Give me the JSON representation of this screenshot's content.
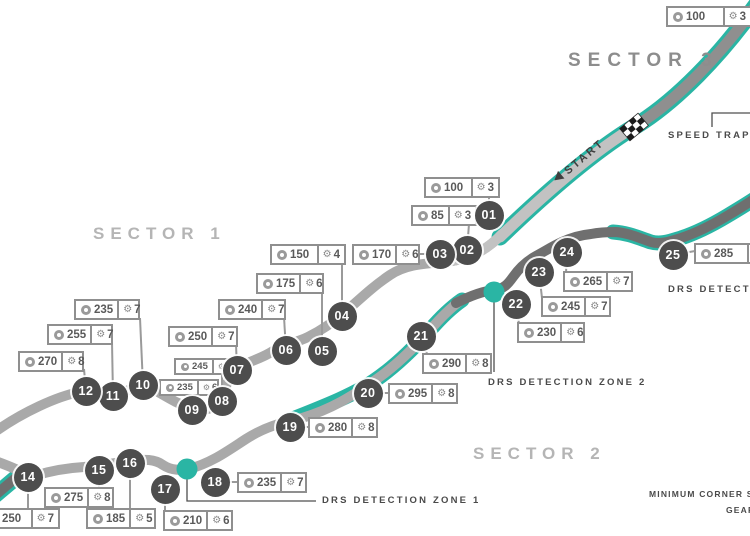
{
  "colors": {
    "teal": "#2ab5a4",
    "track_gray": "#a9a9a9",
    "track_light": "#c2c2c2",
    "track_dark": "#6f6f6f",
    "marker": "#4d4d4d"
  },
  "sector_labels": [
    "SECTOR 1",
    "SECTOR 2",
    "SECTOR 3"
  ],
  "start_label": "START",
  "speed_trap_label": "SPEED TRAP",
  "drs_labels": [
    "DRS DETECTION ZONE 1",
    "DRS DETECTION ZONE 2",
    "DRS DETECTION ZONE 3"
  ],
  "legend": {
    "speed_label": "MINIMUM CORNER SPEED",
    "gear_label": "GEAR"
  },
  "extra_label": {
    "speed": "100",
    "gear": "3",
    "bx": 666,
    "by": 6,
    "bw": 86
  },
  "corners": [
    {
      "num": "01",
      "speed": "100",
      "gear": "3",
      "cx": 489,
      "cy": 215,
      "bx": 424,
      "by": 177,
      "bw": 76,
      "small": false,
      "conn": [
        [
          489,
          215
        ],
        [
          489,
          198
        ]
      ]
    },
    {
      "num": "02",
      "speed": "85",
      "gear": "3",
      "cx": 467,
      "cy": 250,
      "bx": 411,
      "by": 205,
      "bw": 66,
      "small": false,
      "conn": [
        [
          467,
          250
        ],
        [
          469,
          224
        ]
      ]
    },
    {
      "num": "03",
      "speed": "170",
      "gear": "6",
      "cx": 440,
      "cy": 254,
      "bx": 352,
      "by": 244,
      "bw": 68,
      "small": false,
      "conn": [
        [
          440,
          254
        ],
        [
          418,
          254
        ]
      ]
    },
    {
      "num": "04",
      "speed": "150",
      "gear": "4",
      "cx": 342,
      "cy": 316,
      "bx": 270,
      "by": 244,
      "bw": 76,
      "small": false,
      "conn": [
        [
          342,
          316
        ],
        [
          342,
          262
        ]
      ]
    },
    {
      "num": "05",
      "speed": "175",
      "gear": "6",
      "cx": 322,
      "cy": 351,
      "bx": 256,
      "by": 273,
      "bw": 68,
      "small": false,
      "conn": [
        [
          322,
          351
        ],
        [
          322,
          291
        ]
      ]
    },
    {
      "num": "06",
      "speed": "240",
      "gear": "7",
      "cx": 286,
      "cy": 350,
      "bx": 218,
      "by": 299,
      "bw": 68,
      "small": false,
      "conn": [
        [
          286,
          350
        ],
        [
          284,
          317
        ]
      ]
    },
    {
      "num": "07",
      "speed": "250",
      "gear": "7",
      "cx": 237,
      "cy": 370,
      "bx": 168,
      "by": 326,
      "bw": 70,
      "small": false,
      "conn": [
        [
          237,
          370
        ],
        [
          236,
          344
        ]
      ]
    },
    {
      "num": "08",
      "speed": "245",
      "gear": "7",
      "cx": 222,
      "cy": 401,
      "bx": 174,
      "by": 358,
      "bw": 60,
      "small": true,
      "conn": [
        [
          222,
          401
        ],
        [
          222,
          374
        ]
      ]
    },
    {
      "num": "09",
      "speed": "235",
      "gear": "6",
      "cx": 192,
      "cy": 410,
      "bx": 159,
      "by": 379,
      "bw": 60,
      "small": true,
      "conn": [
        [
          192,
          410
        ],
        [
          192,
          395
        ]
      ]
    },
    {
      "num": "10",
      "speed": "235",
      "gear": "7",
      "cx": 143,
      "cy": 385,
      "bx": 74,
      "by": 299,
      "bw": 66,
      "small": false,
      "conn": [
        [
          143,
          385
        ],
        [
          140,
          318
        ]
      ]
    },
    {
      "num": "11",
      "speed": "255",
      "gear": "7",
      "cx": 113,
      "cy": 396,
      "bx": 47,
      "by": 324,
      "bw": 66,
      "small": false,
      "conn": [
        [
          113,
          396
        ],
        [
          112,
          342
        ]
      ]
    },
    {
      "num": "12",
      "speed": "270",
      "gear": "8",
      "cx": 86,
      "cy": 391,
      "bx": 18,
      "by": 351,
      "bw": 66,
      "small": false,
      "conn": [
        [
          86,
          391
        ],
        [
          84,
          369
        ]
      ]
    },
    {
      "num": "14",
      "speed": "250",
      "gear": "7",
      "cx": 28,
      "cy": 477,
      "bx": -18,
      "by": 508,
      "bw": 78,
      "small": false,
      "conn": [
        [
          28,
          477
        ],
        [
          28,
          509
        ]
      ]
    },
    {
      "num": "15",
      "speed": "275",
      "gear": "8",
      "cx": 99,
      "cy": 470,
      "bx": 44,
      "by": 487,
      "bw": 70,
      "small": false,
      "conn": [
        [
          99,
          470
        ],
        [
          99,
          489
        ]
      ]
    },
    {
      "num": "16",
      "speed": "185",
      "gear": "5",
      "cx": 130,
      "cy": 463,
      "bx": 86,
      "by": 508,
      "bw": 70,
      "small": false,
      "conn": [
        [
          130,
          463
        ],
        [
          130,
          509
        ]
      ]
    },
    {
      "num": "17",
      "speed": "210",
      "gear": "6",
      "cx": 165,
      "cy": 489,
      "bx": 163,
      "by": 510,
      "bw": 70,
      "small": false,
      "conn": [
        [
          165,
          489
        ],
        [
          165,
          511
        ]
      ]
    },
    {
      "num": "18",
      "speed": "235",
      "gear": "7",
      "cx": 215,
      "cy": 482,
      "bx": 237,
      "by": 472,
      "bw": 70,
      "small": false,
      "conn": [
        [
          215,
          482
        ],
        [
          238,
          482
        ]
      ]
    },
    {
      "num": "19",
      "speed": "280",
      "gear": "8",
      "cx": 290,
      "cy": 427,
      "bx": 308,
      "by": 417,
      "bw": 70,
      "small": false,
      "conn": [
        [
          290,
          427
        ],
        [
          309,
          427
        ]
      ]
    },
    {
      "num": "20",
      "speed": "295",
      "gear": "8",
      "cx": 368,
      "cy": 393,
      "bx": 388,
      "by": 383,
      "bw": 70,
      "small": false,
      "conn": [
        [
          368,
          393
        ],
        [
          389,
          393
        ]
      ]
    },
    {
      "num": "21",
      "speed": "290",
      "gear": "8",
      "cx": 421,
      "cy": 336,
      "bx": 422,
      "by": 353,
      "bw": 70,
      "small": false,
      "conn": [
        [
          421,
          336
        ],
        [
          427,
          354
        ]
      ]
    },
    {
      "num": "22",
      "speed": "230",
      "gear": "6",
      "cx": 516,
      "cy": 304,
      "bx": 517,
      "by": 322,
      "bw": 68,
      "small": false,
      "conn": [
        [
          516,
          304
        ],
        [
          519,
          324
        ]
      ]
    },
    {
      "num": "23",
      "speed": "245",
      "gear": "7",
      "cx": 539,
      "cy": 272,
      "bx": 541,
      "by": 296,
      "bw": 70,
      "small": false,
      "conn": [
        [
          539,
          272
        ],
        [
          542,
          298
        ]
      ]
    },
    {
      "num": "24",
      "speed": "265",
      "gear": "7",
      "cx": 567,
      "cy": 252,
      "bx": 563,
      "by": 271,
      "bw": 70,
      "small": false,
      "conn": [
        [
          567,
          252
        ],
        [
          566,
          273
        ]
      ]
    },
    {
      "num": "25",
      "speed": "285",
      "gear": "",
      "cx": 673,
      "cy": 255,
      "bx": 694,
      "by": 243,
      "bw": 76,
      "small": false,
      "conn": [
        [
          673,
          255
        ],
        [
          695,
          251
        ]
      ]
    }
  ]
}
